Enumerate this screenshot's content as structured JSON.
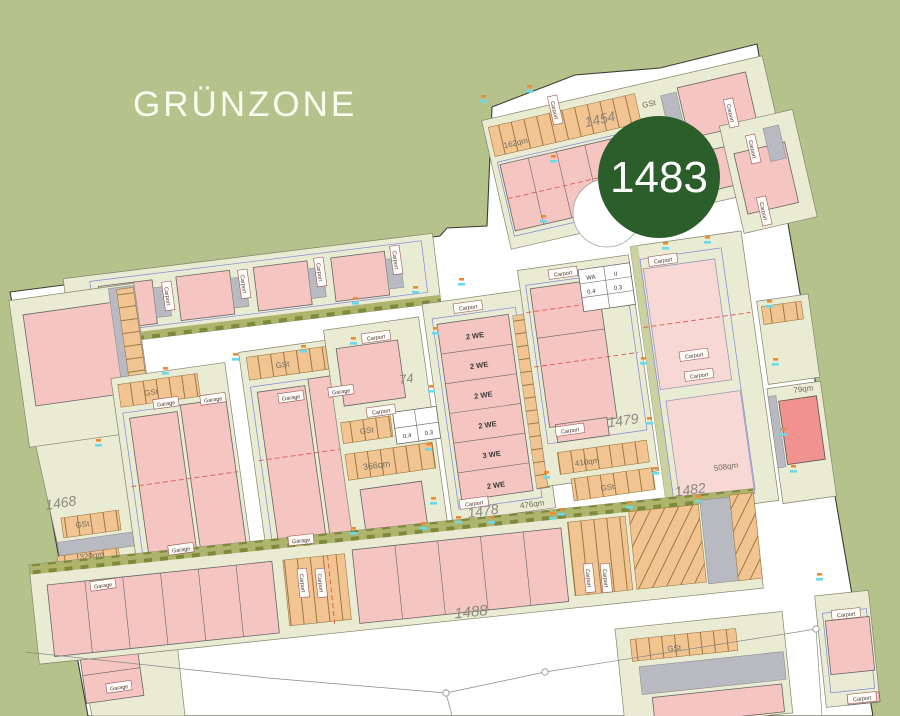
{
  "colors": {
    "canvas_bg": "#b5c28b",
    "site_fill": "#ffffff",
    "parcel_fill": "#e9ebd3",
    "parcel_stroke": "#84846c",
    "building_pink": "#f5c5c2",
    "building_pink_light": "#f8d8d4",
    "building_red": "#f2928e",
    "carport_gray": "#b9bac1",
    "stall_orange": "#f2c492",
    "stall_stroke": "#9a7a40",
    "tree_strip": "#aeb46b",
    "badge_green": "#2b5e2b",
    "badge_text": "#ffffff",
    "parcel_number_text": "#86867c",
    "area_text": "#6e6e60",
    "tick_cyan": "#6cd9e8",
    "tick_orange": "#ef8a32",
    "red_dash": "#e05a52",
    "blue_line": "#8084d8",
    "boundary": "#3c3c34",
    "greenzone_text": "#fbfbf2"
  },
  "greenzone": {
    "label": "GRÜNZONE"
  },
  "badge": {
    "value": "1483"
  },
  "labels": {
    "carport": "Carport",
    "garage": "Garage",
    "gst": "GSt"
  },
  "parcels": {
    "p1454": {
      "number": "1454",
      "area": "162qm",
      "parking": "GSt"
    },
    "p1479": {
      "number": "1479",
      "area": "410qm",
      "parking": "GSt"
    },
    "p1478": {
      "number": "1478",
      "area": "476qm"
    },
    "p1482": {
      "number": "1482",
      "area": "508qm"
    },
    "p1488": {
      "number": "1488"
    },
    "p1471": {
      "number": "1471",
      "area": "395qm"
    },
    "p1468": {
      "number": "1468",
      "area": "320qm",
      "parking": "GSt"
    },
    "p1474": {
      "number": "74",
      "area": "366qm",
      "parking": "GSt"
    },
    "p147x": {
      "number": "147"
    },
    "p_right": {
      "area": "79qm"
    }
  },
  "units": {
    "list": [
      "2 WE",
      "2 WE",
      "2 WE",
      "2 WE",
      "3 WE",
      "2 WE"
    ]
  },
  "stamp": {
    "c1": "WA",
    "c2": "II",
    "c3": "0.4",
    "c4": "0.3"
  },
  "map": {
    "ticks": [
      [
        352,
        302
      ],
      [
        412,
        291
      ],
      [
        458,
        283
      ],
      [
        350,
        342
      ],
      [
        300,
        350
      ],
      [
        232,
        358
      ],
      [
        162,
        372
      ],
      [
        95,
        444
      ],
      [
        432,
        332
      ],
      [
        428,
        390
      ],
      [
        425,
        448
      ],
      [
        430,
        502
      ],
      [
        455,
        521
      ],
      [
        543,
        476
      ],
      [
        549,
        517
      ],
      [
        540,
        220
      ],
      [
        582,
        211
      ],
      [
        550,
        160
      ],
      [
        350,
        532
      ],
      [
        420,
        527
      ],
      [
        488,
        521
      ],
      [
        558,
        513
      ],
      [
        626,
        506
      ],
      [
        695,
        500
      ],
      [
        640,
        362
      ],
      [
        646,
        422
      ],
      [
        652,
        472
      ],
      [
        480,
        100
      ],
      [
        526,
        90
      ],
      [
        662,
        247
      ],
      [
        704,
        241
      ],
      [
        766,
        305
      ],
      [
        772,
        363
      ],
      [
        780,
        433
      ],
      [
        816,
        578
      ],
      [
        790,
        470
      ]
    ],
    "label_boxes": [
      {
        "t": "carport",
        "x": 168,
        "y": 296,
        "r": 82
      },
      {
        "t": "carport",
        "x": 244,
        "y": 284,
        "r": 82
      },
      {
        "t": "carport",
        "x": 320,
        "y": 272,
        "r": 82
      },
      {
        "t": "carport",
        "x": 396,
        "y": 260,
        "r": 82
      },
      {
        "t": "carport",
        "x": 376,
        "y": 337,
        "r": -8
      },
      {
        "t": "carport",
        "x": 381,
        "y": 411,
        "r": -8
      },
      {
        "t": "carport",
        "x": 468,
        "y": 307,
        "r": -8
      },
      {
        "t": "carport",
        "x": 474,
        "y": 503,
        "r": -8
      },
      {
        "t": "carport",
        "x": 563,
        "y": 273,
        "r": -8
      },
      {
        "t": "carport",
        "x": 570,
        "y": 430,
        "r": -8
      },
      {
        "t": "carport",
        "x": 663,
        "y": 260,
        "r": -8
      },
      {
        "t": "carport",
        "x": 694,
        "y": 355,
        "r": -8
      },
      {
        "t": "carport",
        "x": 699,
        "y": 375,
        "r": -8
      },
      {
        "t": "carport",
        "x": 555,
        "y": 110,
        "r": 77
      },
      {
        "t": "carport",
        "x": 731,
        "y": 113,
        "r": 77
      },
      {
        "t": "carport",
        "x": 753,
        "y": 149,
        "r": 77
      },
      {
        "t": "carport",
        "x": 764,
        "y": 211,
        "r": 77
      },
      {
        "t": "carport",
        "x": 846,
        "y": 614,
        "r": -6
      },
      {
        "t": "carport",
        "x": 862,
        "y": 698,
        "r": -6
      },
      {
        "t": "carport",
        "x": 303,
        "y": 583,
        "r": 84
      },
      {
        "t": "carport",
        "x": 321,
        "y": 583,
        "r": 84
      },
      {
        "t": "carport",
        "x": 589,
        "y": 578,
        "r": 84
      },
      {
        "t": "carport",
        "x": 606,
        "y": 578,
        "r": 84
      },
      {
        "t": "garage",
        "x": 166,
        "y": 403,
        "r": -8
      },
      {
        "t": "garage",
        "x": 213,
        "y": 399,
        "r": -8
      },
      {
        "t": "garage",
        "x": 181,
        "y": 549,
        "r": -8
      },
      {
        "t": "garage",
        "x": 291,
        "y": 397,
        "r": -8
      },
      {
        "t": "garage",
        "x": 341,
        "y": 391,
        "r": -8
      },
      {
        "t": "garage",
        "x": 301,
        "y": 540,
        "r": -6
      },
      {
        "t": "garage",
        "x": 103,
        "y": 585,
        "r": -8
      },
      {
        "t": "garage",
        "x": 119,
        "y": 687,
        "r": -8
      }
    ]
  }
}
